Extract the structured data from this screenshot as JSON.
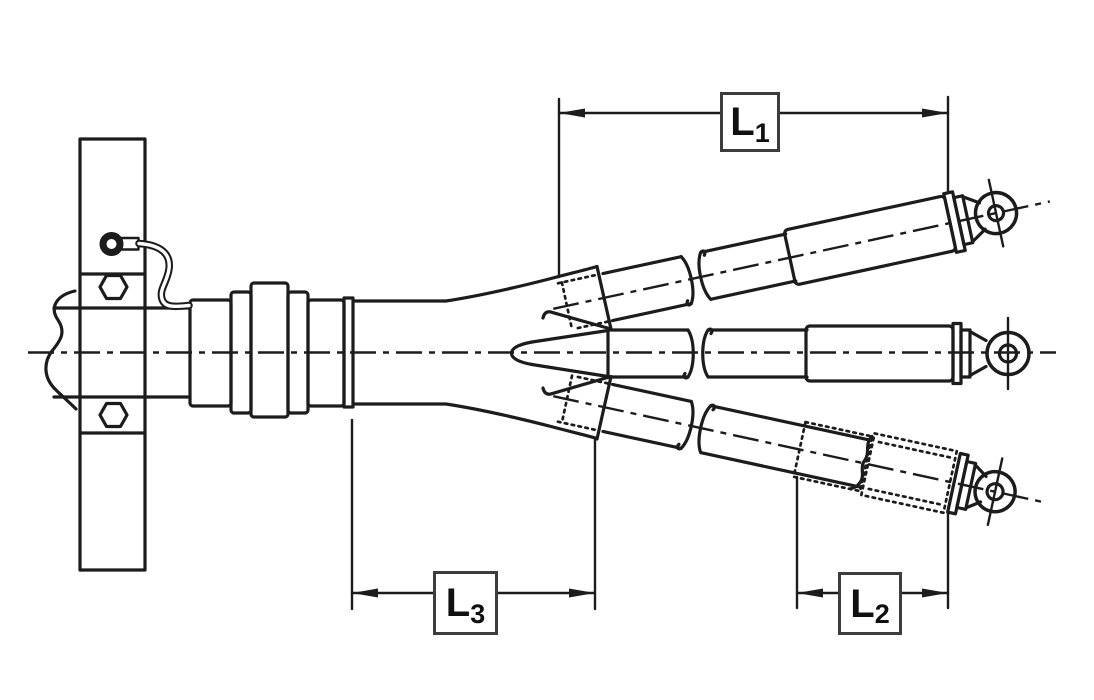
{
  "diagram": {
    "background_color": "#ffffff",
    "line_color": "#1c1c1c",
    "dimension_labels": {
      "l1": {
        "main": "L",
        "sub": "1"
      },
      "l2": {
        "main": "L",
        "sub": "2"
      },
      "l3": {
        "main": "L",
        "sub": "3"
      }
    }
  }
}
